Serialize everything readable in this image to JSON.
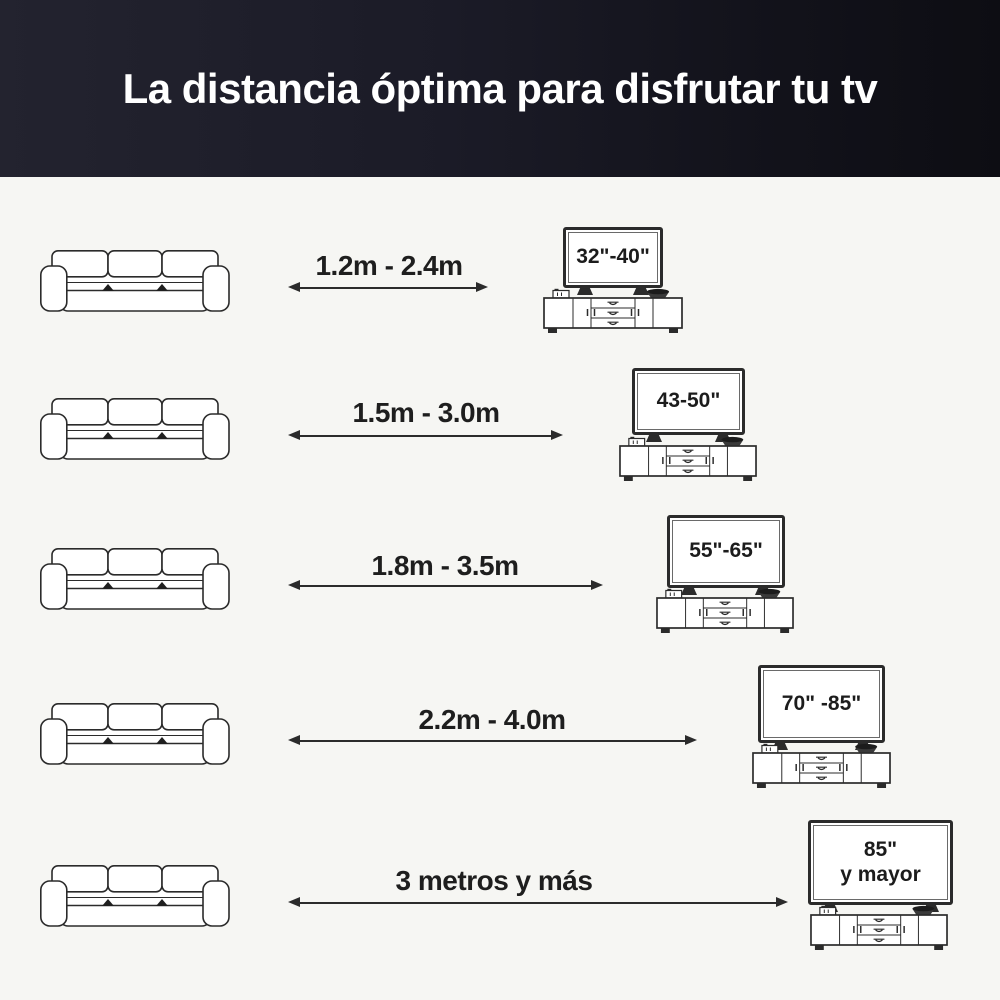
{
  "header": {
    "title": "La distancia óptima para disfrutar tu tv",
    "bg_color": "#16161f",
    "text_color": "#ffffff"
  },
  "colors": {
    "background": "#f6f6f3",
    "line_art": "#2b2b2b",
    "label_text": "#1e1e1e"
  },
  "icons": {
    "sofa": "sofa-icon",
    "tv": "tv-icon",
    "tv_stand": "tv-stand-icon",
    "arrow": "double-headed-arrow-icon"
  },
  "rows": [
    {
      "distance": "1.2m - 2.4m",
      "tv_size": "32\"-40\""
    },
    {
      "distance": "1.5m - 3.0m",
      "tv_size": "43-50\""
    },
    {
      "distance": "1.8m - 3.5m",
      "tv_size": "55\"-65\""
    },
    {
      "distance": "2.2m - 4.0m",
      "tv_size": "70\" -85\""
    },
    {
      "distance": "3 metros y más",
      "tv_size": "85\"",
      "tv_size_line2": "y mayor"
    }
  ]
}
